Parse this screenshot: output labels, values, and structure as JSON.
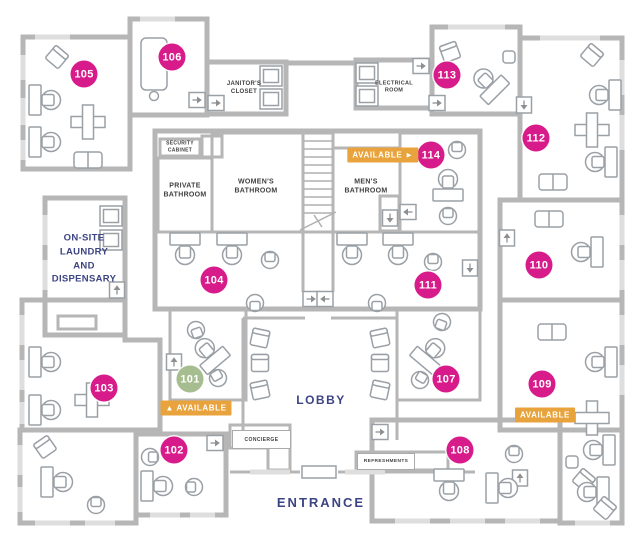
{
  "floorplan": {
    "rooms": {
      "r101": {
        "number": "101",
        "status": "available"
      },
      "r102": {
        "number": "102",
        "status": "occupied"
      },
      "r103": {
        "number": "103",
        "status": "occupied"
      },
      "r104": {
        "number": "104",
        "status": "occupied"
      },
      "r105": {
        "number": "105",
        "status": "occupied"
      },
      "r106": {
        "number": "106",
        "status": "occupied"
      },
      "r107": {
        "number": "107",
        "status": "occupied"
      },
      "r108": {
        "number": "108",
        "status": "occupied"
      },
      "r109": {
        "number": "109",
        "status": "available"
      },
      "r110": {
        "number": "110",
        "status": "occupied"
      },
      "r111": {
        "number": "111",
        "status": "occupied"
      },
      "r112": {
        "number": "112",
        "status": "occupied"
      },
      "r113": {
        "number": "113",
        "status": "occupied"
      },
      "r114": {
        "number": "114",
        "status": "available"
      }
    },
    "available_tags": {
      "t114": "AVAILABLE ►",
      "t101": "▲ AVAILABLE",
      "t109": "AVAILABLE"
    },
    "areas": {
      "janitors_closet": "JANITOR'S\nCLOSET",
      "electrical_room": "ELECTRICAL\nROOM",
      "security_cabinet": "SECURITY\nCABINET",
      "private_bathroom": "PRIVATE\nBATHROOM",
      "womens_bathroom": "WOMEN'S\nBATHROOM",
      "mens_bathroom": "MEN'S\nBATHROOM",
      "laundry": "ON-SITE\nLAUNDRY\nAND\nDISPENSARY",
      "lobby": "LOBBY",
      "entrance": "ENTRANCE",
      "concierge": "CONCIERGE",
      "refreshments": "REFRESHMENTS"
    },
    "colors": {
      "badge_pink": "#d81b8a",
      "badge_green": "#a6bd8f",
      "tag_orange": "#e8a33d",
      "text_navy": "#3d4483",
      "wall_gray": "#b6b6b6"
    }
  }
}
